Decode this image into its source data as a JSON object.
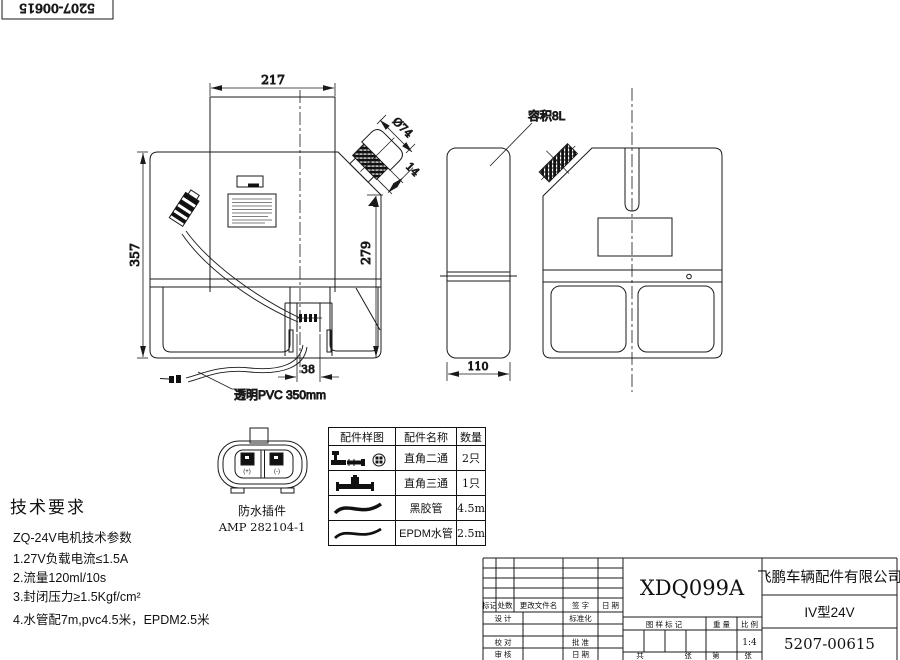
{
  "corner_ref": {
    "value": "5207-00615"
  },
  "views": {
    "front": {
      "dim_width": "217",
      "dim_height": "357",
      "dim_right_height": "279",
      "dim_outlet": "38",
      "dim_neck_dia": "Ø74",
      "dim_neck_len": "14",
      "hose_label": "透明PVC 350mm"
    },
    "side": {
      "dim_width": "110",
      "capacity_label": "容积8L"
    }
  },
  "connector": {
    "name": "防水插件",
    "model": "AMP 282104-1",
    "plus": "(+)",
    "minus": "(-)"
  },
  "parts_table": {
    "headers": [
      "配件样图",
      "配件名称",
      "数量"
    ],
    "rows": [
      {
        "icon": "elbow-two-way-fitting",
        "name": "直角二通",
        "qty": "2只"
      },
      {
        "icon": "tee-three-way-fitting",
        "name": "直角三通",
        "qty": "1只"
      },
      {
        "icon": "hose-curve",
        "name": "黑胶管",
        "qty": "4.5m"
      },
      {
        "icon": "hose-curve",
        "name": "EPDM水管",
        "qty": "2.5m"
      }
    ]
  },
  "tech_req": {
    "title": "技术要求",
    "subtitle": "ZQ-24V电机技术参数",
    "items": [
      "1.27V负载电流≤1.5A",
      "2.流量120ml/10s",
      "3.封闭压力≥1.5Kgf/cm²",
      "4.水管配7m,pvc4.5米，EPDM2.5米"
    ]
  },
  "title_block": {
    "drawing_code": "XDQ099A",
    "company": "飞鹏车辆配件有限公司",
    "model": "IV型24V",
    "part_number": "5207-00615",
    "scale_value": "1:4",
    "labels": {
      "mark": "标记",
      "qty": "处数",
      "changed_file": "更改文件名",
      "sign": "签 字",
      "date": "日 期",
      "design": "设 计",
      "standardization": "标准化",
      "proofread": "校 对",
      "approve": "批 准",
      "review": "审 核",
      "date2": "日 期",
      "pattern_mark": "图 样 标 记",
      "weight": "重 量",
      "scale": "比 例",
      "total": "共",
      "sheets": "张",
      "no": "第",
      "sheet": "张"
    }
  }
}
